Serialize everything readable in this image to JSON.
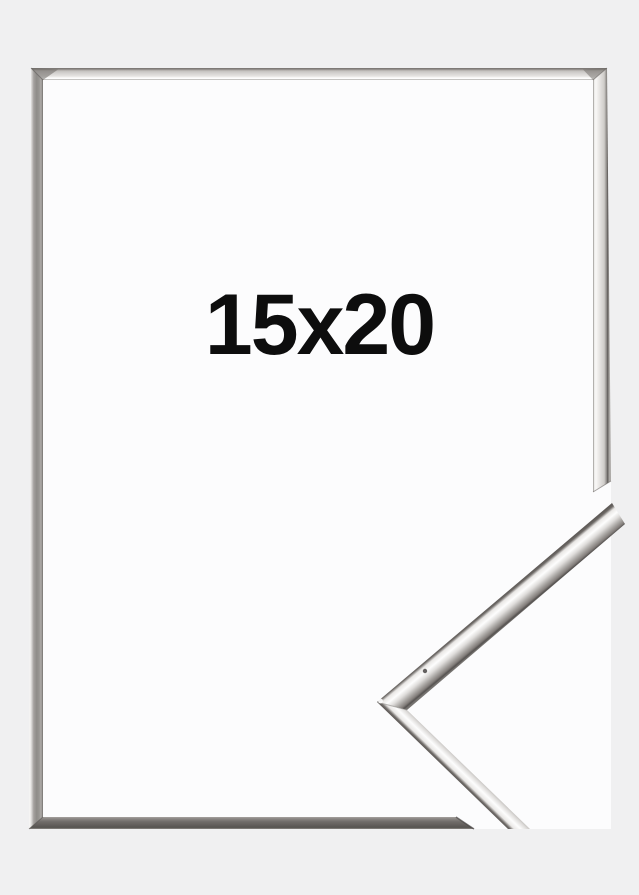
{
  "image": {
    "label": "15x20",
    "subject": "silver picture frame with mitred corner detail"
  },
  "colors": {
    "background": "#f0f0f1",
    "frame_interior": "#fcfcfd",
    "label_text": "#0d0d0d",
    "frame_highlight": "#fdfdfd",
    "frame_mid_silver": "#b5b2af",
    "frame_dark_edge": "#5f5b58"
  }
}
